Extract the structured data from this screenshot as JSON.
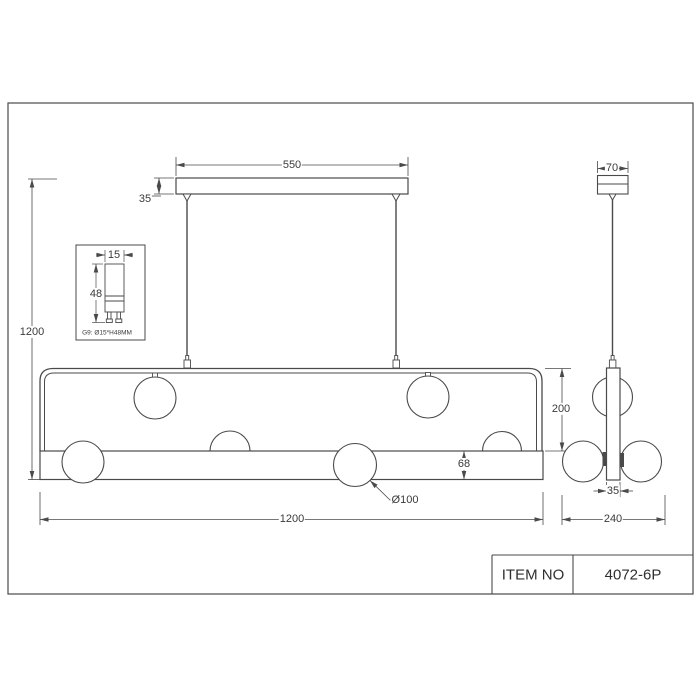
{
  "drawing": {
    "front_view": {
      "canopy_width": "550",
      "canopy_height": "35",
      "drop_height": "1200",
      "frame_height": "200",
      "bar_height": "68",
      "globe_diameter": "Ø100",
      "fixture_width": "1200"
    },
    "side_view": {
      "canopy_width": "70",
      "bar_width": "35",
      "total_width": "240"
    },
    "bulb_detail": {
      "bulb_width": "15",
      "bulb_height": "48",
      "caption": "G9: Ø15*H48MM"
    },
    "title_block": {
      "label": "ITEM NO",
      "value": "4072-6P"
    },
    "colors": {
      "line": "#4a4a4a",
      "text": "#3a3a3a",
      "background": "#ffffff"
    }
  }
}
